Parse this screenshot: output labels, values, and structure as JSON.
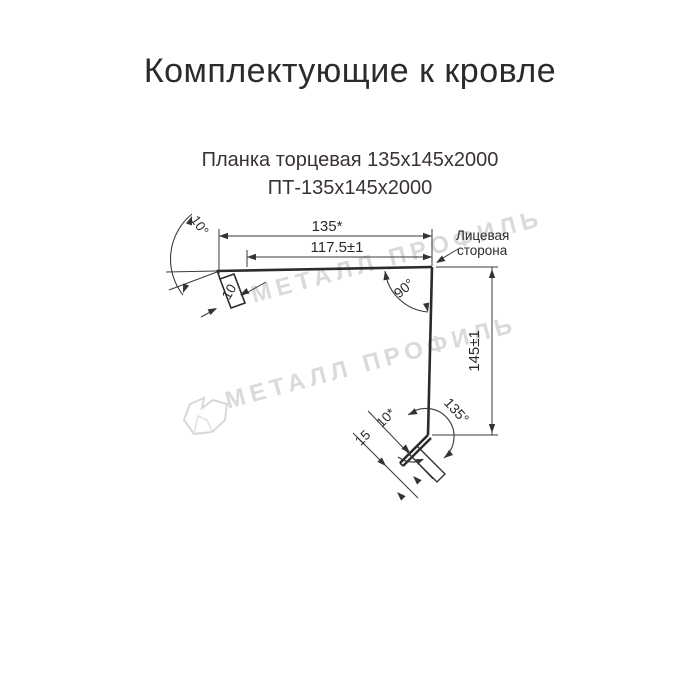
{
  "header": {
    "title": "Комплектующие к кровле"
  },
  "product": {
    "name": "Планка торцевая 135х145х2000",
    "code": "ПТ-135х145х2000"
  },
  "drawing": {
    "dimensions": {
      "top_width": "135*",
      "top_inner_width": "117.5±1",
      "top_bend_angle": "10°",
      "top_hem_length": "10",
      "corner_angle": "90°",
      "side_height": "145±1",
      "bottom_bend_angle": "135°",
      "bottom_hem_length": "10*",
      "bottom_flange_length": "15"
    },
    "labels": {
      "face_side_line1": "Лицевая",
      "face_side_line2": "сторона"
    },
    "colors": {
      "profile_line": "#2b2b2b",
      "dimension_line": "#3a3a3a",
      "watermark": "#dadada"
    }
  },
  "watermark": {
    "text": "МЕТАЛЛ ПРОФИЛЬ",
    "logo": "metall-profil-logo"
  }
}
